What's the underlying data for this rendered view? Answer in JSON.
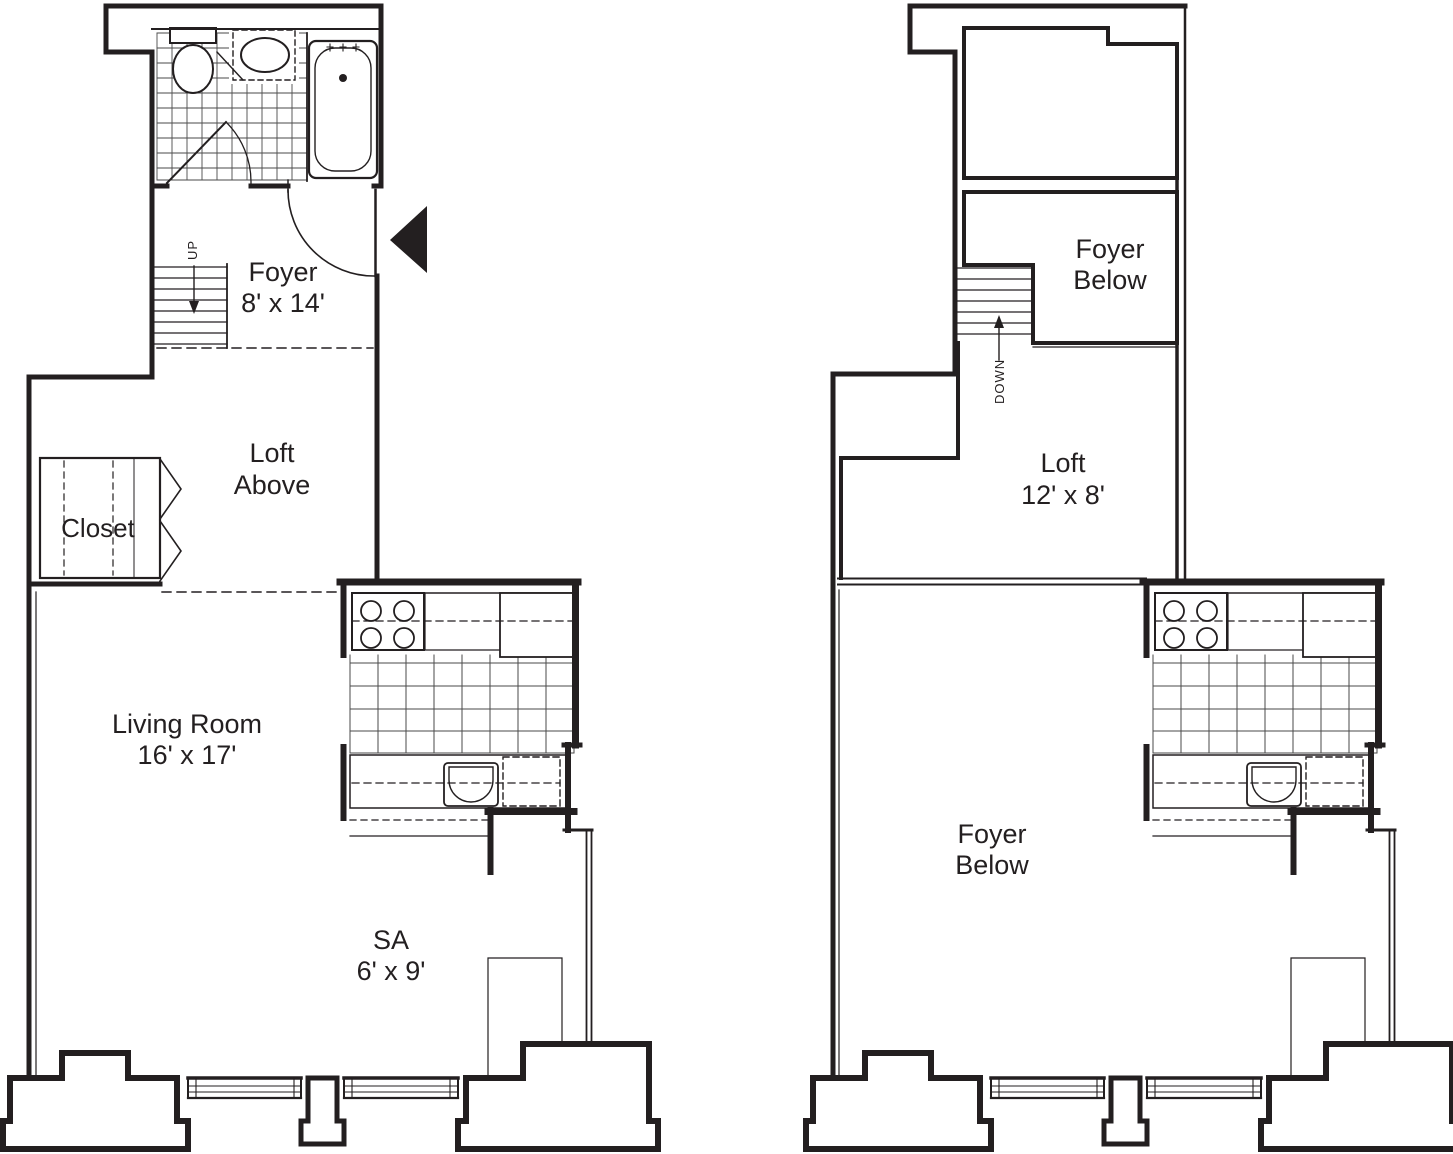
{
  "colors": {
    "ink": "#231f20",
    "background": "#ffffff",
    "tile_grid": "#4a4a4a"
  },
  "main_floor": {
    "foyer": {
      "name": "Foyer",
      "dims": "8' x 14'"
    },
    "loft_above": {
      "line1": "Loft",
      "line2": "Above"
    },
    "closet": {
      "name": "Closet"
    },
    "living_room": {
      "name": "Living Room",
      "dims": "16' x 17'"
    },
    "sa": {
      "name": "SA",
      "dims": "6' x 9'"
    },
    "stairs": {
      "direction": "UP"
    }
  },
  "upper_floor": {
    "foyer_below_upper": {
      "line1": "Foyer",
      "line2": "Below"
    },
    "loft": {
      "name": "Loft",
      "dims": "12' x 8'"
    },
    "foyer_below_lower": {
      "line1": "Foyer",
      "line2": "Below"
    },
    "stairs": {
      "direction": "DOWN"
    }
  }
}
